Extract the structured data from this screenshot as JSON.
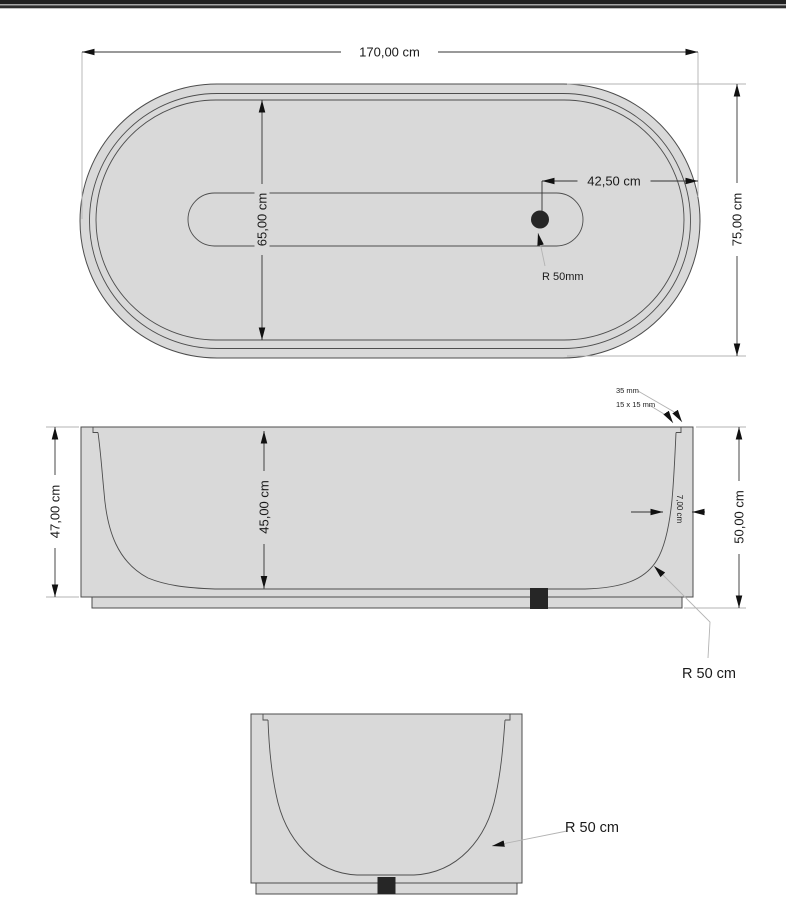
{
  "top_bar": {
    "bar_color": "#212121",
    "accent_line_color": "#a6a6a6",
    "lower_line_color": "#2e2e2e"
  },
  "colors": {
    "body_fill": "#d9d9d9",
    "outline": "#4d4d4d",
    "dimension_line": "#333333",
    "extension_line": "#b3b3b3",
    "arrowhead": "#111111",
    "drain": "#262626",
    "text": "#1a1a1a",
    "background": "#ffffff"
  },
  "top_view": {
    "length": "170,00 cm",
    "overall_width": "75,00 cm",
    "basin_width": "65,00 cm",
    "drain_offset": "42,50 cm",
    "drain_radius": "R 50mm"
  },
  "side_view": {
    "body_height": "47,00 cm",
    "inner_depth": "45,00 cm",
    "overall_height": "50,00 cm",
    "wall_thickness": "7,00 cm",
    "rim_width": "35 mm",
    "rim_notch": "15 x 15 mm",
    "bottom_radius": "R 50 cm"
  },
  "end_view": {
    "bottom_radius": "R 50 cm"
  }
}
